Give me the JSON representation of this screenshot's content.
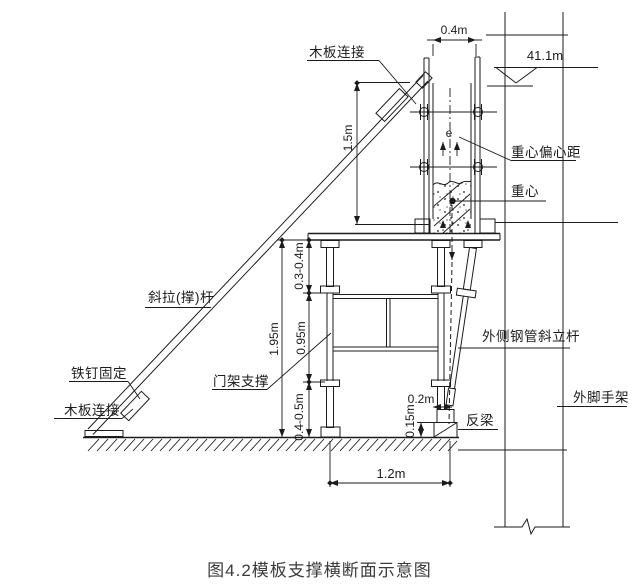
{
  "figure": {
    "caption": "图4.2模板支撑横断面示意图"
  },
  "labels": {
    "board_connection_top": "木板连接",
    "board_connection_bottom": "木板连接",
    "nail_fixing": "铁钉固定",
    "diagonal_brace": "斜拉(撑)杆",
    "frame_support": "门架支撑",
    "eccentric_distance": "重心偏心距",
    "center_of_gravity": "重心",
    "eccentricity_symbol": "e",
    "outer_diagonal_pipe": "外侧钢管斜立杆",
    "outer_scaffold": "外脚手架",
    "inverted_beam": "反梁"
  },
  "dimensions": {
    "top_width": "0.4m",
    "elevation": "41.1m",
    "formwork_height": "1.5m",
    "platform_gap": "0.3-0.4m",
    "frame_height": "0.95m",
    "base_height": "0.4-0.5m",
    "total_height": "1.95m",
    "jack_offset": "0.2m",
    "beam_height": "0.15m",
    "bottom_width": "1.2m"
  },
  "colors": {
    "line": "#1b1b1b",
    "background": "#ffffff",
    "caption_text": "#3b3b3b"
  }
}
